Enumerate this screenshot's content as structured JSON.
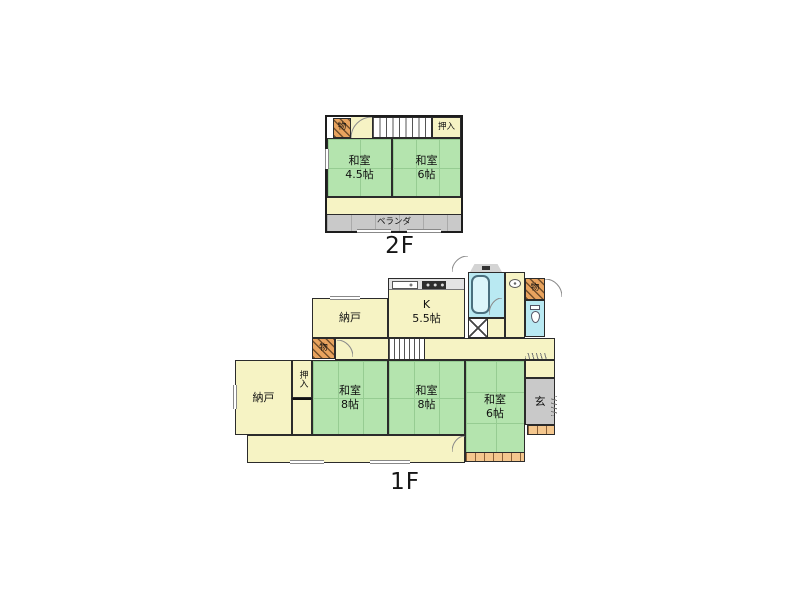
{
  "colors": {
    "room_green": "#b4e4ae",
    "floor_yellow": "#f6f3c4",
    "veranda_gray": "#c9c9c9",
    "wet_area_blue": "#b9e9f2",
    "closet_orange": "#e8a35e",
    "step_orange": "#f4c78e",
    "wall_black": "#2b2b2b"
  },
  "f2": {
    "label": "2F",
    "mono": "物",
    "oshiire": "押入",
    "w45": {
      "l1": "和室",
      "l2": "4.5帖"
    },
    "w6": {
      "l1": "和室",
      "l2": "6帖"
    },
    "veranda": "ベランダ"
  },
  "f1": {
    "label": "1F",
    "nando_upper": "納戸",
    "kitchen": {
      "l1": "K",
      "l2": "5.5帖"
    },
    "mono_top": "物",
    "mono_small": "物",
    "nando_left": "納戸",
    "oshiire": "押入",
    "w8a": {
      "l1": "和室",
      "l2": "8帖"
    },
    "w8b": {
      "l1": "和室",
      "l2": "8帖"
    },
    "w6": {
      "l1": "和室",
      "l2": "6帖"
    },
    "genkan": "玄"
  }
}
